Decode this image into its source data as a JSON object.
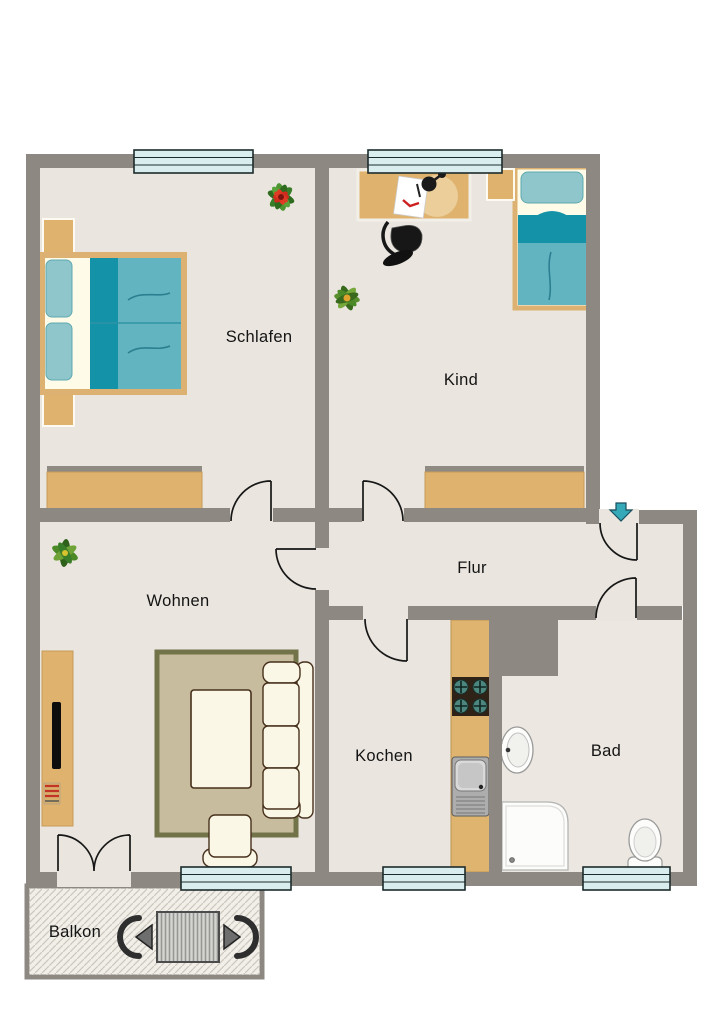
{
  "plan": {
    "rooms": {
      "schlafen": {
        "label": "Schlafen"
      },
      "kind": {
        "label": "Kind"
      },
      "wohnen": {
        "label": "Wohnen"
      },
      "flur": {
        "label": "Flur"
      },
      "kochen": {
        "label": "Kochen"
      },
      "bad": {
        "label": "Bad"
      },
      "balkon": {
        "label": "Balkon"
      }
    },
    "entrance": {
      "indicator": "down-arrow",
      "color": "#35a9b8",
      "location": "flur-top-right"
    },
    "doors_count": 7,
    "windows_count": 5,
    "furniture": {
      "schlafen": [
        "double-bed",
        "nightstand",
        "nightstand",
        "wardrobe",
        "potted-plant-red-flower"
      ],
      "kind": [
        "desk",
        "desk-lamp",
        "paper-sheet",
        "office-chair",
        "single-bed",
        "nightstand",
        "wardrobe",
        "potted-plant"
      ],
      "wohnen": [
        "tv-lowboard",
        "tv",
        "media-stack",
        "rug",
        "coffee-table",
        "sofa-3-seat",
        "armchair",
        "potted-plant"
      ],
      "kochen": [
        "kitchen-counter",
        "stove-4-burners",
        "sink-with-drainboard"
      ],
      "bad": [
        "washbasin",
        "shower",
        "toilet"
      ],
      "balkon": [
        "patio-table",
        "chair",
        "chair"
      ]
    },
    "colors": {
      "wall": "#8d8882",
      "floor": "#eae6df",
      "wood": "#dfb26e",
      "bed_teal_dark": "#1492a8",
      "bed_teal": "#62b5c0",
      "bed_teal_light": "#8ec6cc",
      "window_glass": "#d9edee",
      "upholstery": "#fbf7e6",
      "rug_border": "#73734a",
      "rug_fill": "#c8bc9f",
      "entrance_arrow": "#35a9b8"
    }
  }
}
